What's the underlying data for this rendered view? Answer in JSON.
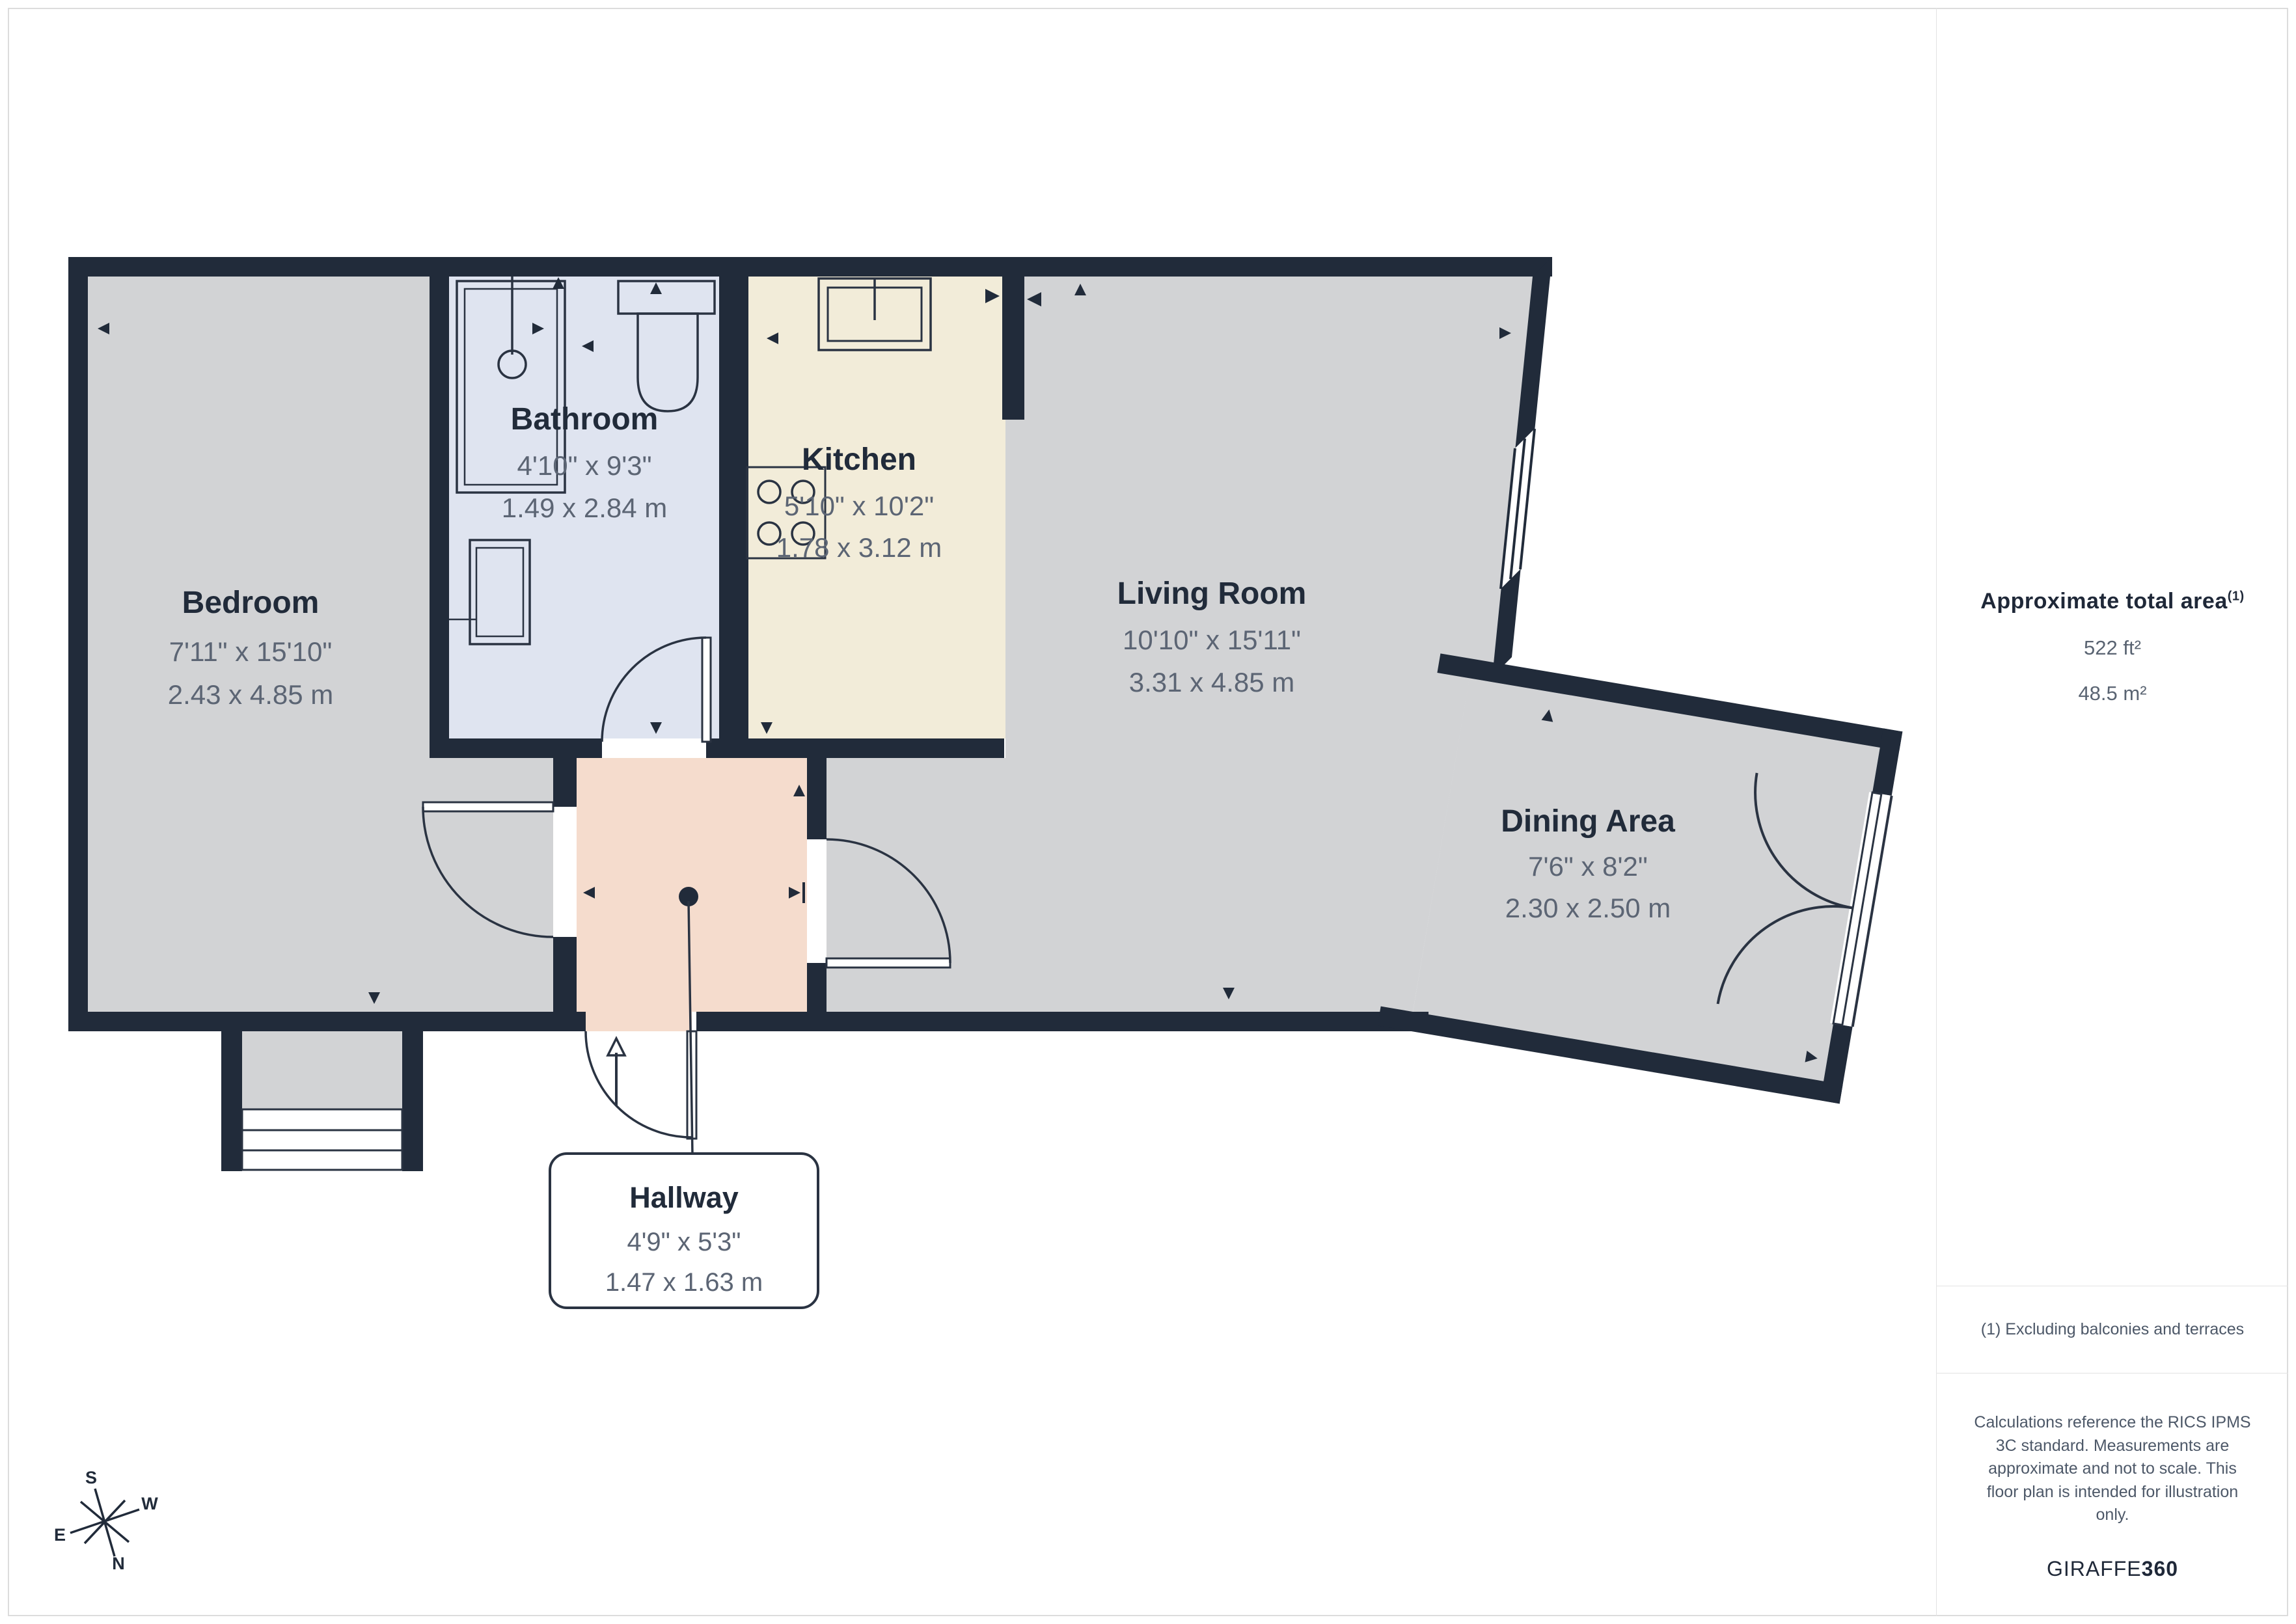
{
  "rooms": {
    "bedroom": {
      "name": "Bedroom",
      "imperial": "7'11\" x 15'10\"",
      "metric": "2.43 x 4.85 m"
    },
    "bathroom": {
      "name": "Bathroom",
      "imperial": "4'10\" x 9'3\"",
      "metric": "1.49 x 2.84 m"
    },
    "kitchen": {
      "name": "Kitchen",
      "imperial": "5'10\" x 10'2\"",
      "metric": "1.78 x 3.12 m"
    },
    "living": {
      "name": "Living Room",
      "imperial": "10'10\" x 15'11\"",
      "metric": "3.31 x 4.85 m"
    },
    "dining": {
      "name": "Dining Area",
      "imperial": "7'6\" x 8'2\"",
      "metric": "2.30 x 2.50 m"
    },
    "hallway": {
      "name": "Hallway",
      "imperial": "4'9\" x 5'3\"",
      "metric": "1.47 x 1.63 m"
    }
  },
  "sidebar": {
    "title": "Approximate total area",
    "title_superscript": "(1)",
    "area_imperial": "522 ft²",
    "area_metric": "48.5 m²",
    "footnote": "(1) Excluding balconies and terraces",
    "disclaimer": "Calculations reference the RICS IPMS 3C standard. Measurements are approximate and not to scale. This floor plan is intended for illustration only.",
    "brand_regular": "GIRAFFE",
    "brand_bold": "360"
  },
  "compass": {
    "north": "N",
    "south": "S",
    "east": "E",
    "west": "W"
  },
  "colors": {
    "wall": "#212b3a",
    "room_gray": "#d2d3d5",
    "bathroom_fill": "#dfe4f0",
    "kitchen_fill": "#f2ecd9",
    "hallway_fill": "#f5dccd",
    "label_dark": "#212b3a",
    "label_gray": "#5c6574"
  }
}
